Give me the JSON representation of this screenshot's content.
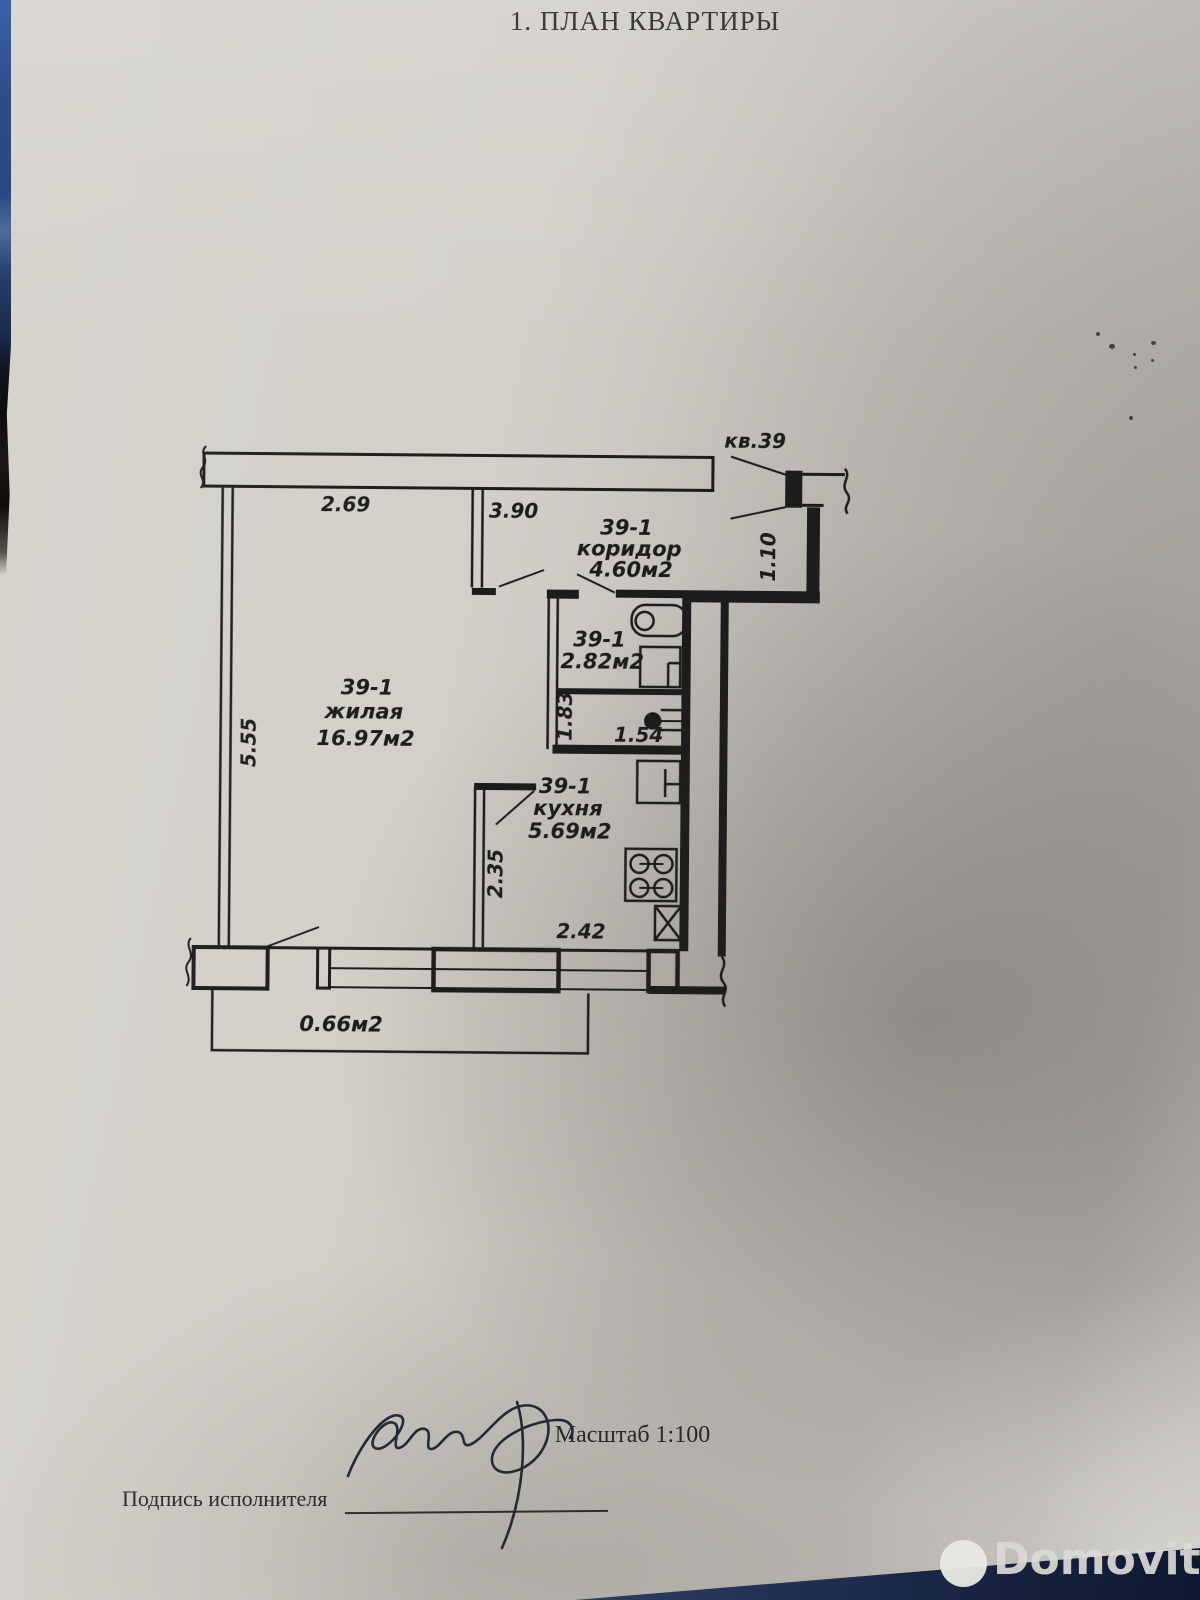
{
  "page": {
    "title": "1. ПЛАН КВАРТИРЫ"
  },
  "plan": {
    "apartment_label": "кв.39",
    "rooms": {
      "living": {
        "id": "39-1",
        "name": "жилая",
        "area": "16.97м2"
      },
      "corridor": {
        "id": "39-1",
        "name": "коридор",
        "area": "4.60м2"
      },
      "bathroom": {
        "id": "39-1",
        "area": "2.82м2"
      },
      "kitchen": {
        "id": "39-1",
        "name": "кухня",
        "area": "5.69м2"
      },
      "balcony": {
        "area": "0.66м2"
      }
    },
    "dimensions": {
      "d269": "2.69",
      "d390": "3.90",
      "d555": "5.55",
      "d110": "1.10",
      "d183": "1.83",
      "d154": "1.54",
      "d235": "2.35",
      "d242": "2.42"
    }
  },
  "footer": {
    "scale_note": "Масштаб 1:100",
    "signature_label": "Подпись исполнителя"
  },
  "watermark": {
    "brand": "Domovita"
  },
  "colors": {
    "ink": "#1c1c1c",
    "paper": "#d3d0ca",
    "navy_wedge": "#16233f",
    "edge_blue": "#2a4a85",
    "watermark_text": "#dcdad6"
  }
}
